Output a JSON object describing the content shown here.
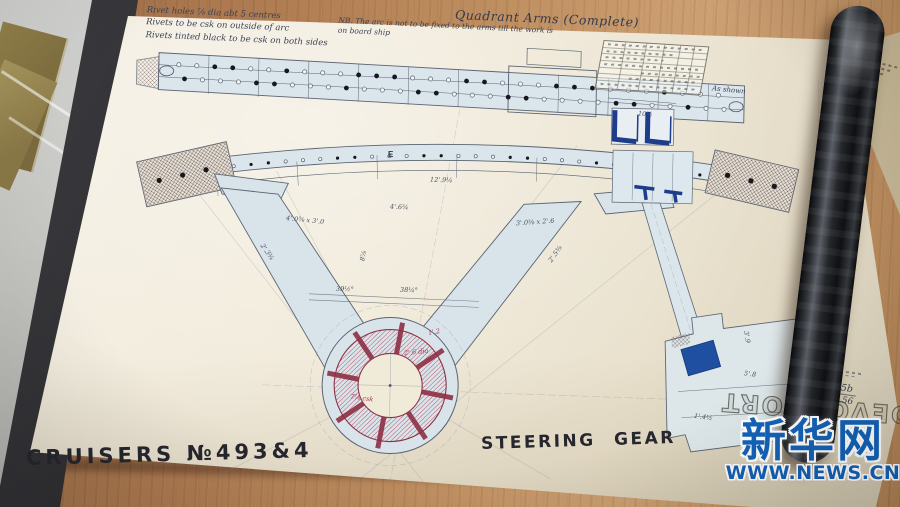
{
  "drawing": {
    "series_title": "CRUISERS №493&4",
    "sheet_title": "STEERING GEAR",
    "view_title": "Quadrant Arms (Complete)",
    "corner_stamp": "DEVONPORT",
    "notes": {
      "rivet_1": "Rivet holes ⅞ dia abt 5 centres",
      "rivet_2": "Rivets to be csk on outside of arc",
      "rivet_3": "Rivets tinted black to be csk on both sides",
      "arc": "NB. The arc is not to be fixed to the arms till the work is on board ship",
      "side": "As shown",
      "ref_no": "6005b",
      "ref_date": "19.3.56"
    },
    "dims": [
      "4'.6¾",
      "12'.9¼",
      "4'.0⅜ x 3'.0",
      "3'.0⅜ x 2'.6",
      "8⅞",
      "39½°",
      "38¼°",
      "2'.3¾",
      "2'.5⅜",
      "5'.8",
      "1'.4½",
      "3'.9",
      "10½",
      "E"
    ],
    "red_dims": [
      "2'.6 dia",
      "7⅞ csk",
      "1'.2"
    ],
    "ink_color": "#5a6472",
    "tint_color": "#dae5ec",
    "navy_color": "#1d3c8a",
    "red_color": "#8f2f44"
  },
  "watermark": {
    "brand": "新华网",
    "url": "WWW.NEWS.CN",
    "color": "#1463b8"
  }
}
